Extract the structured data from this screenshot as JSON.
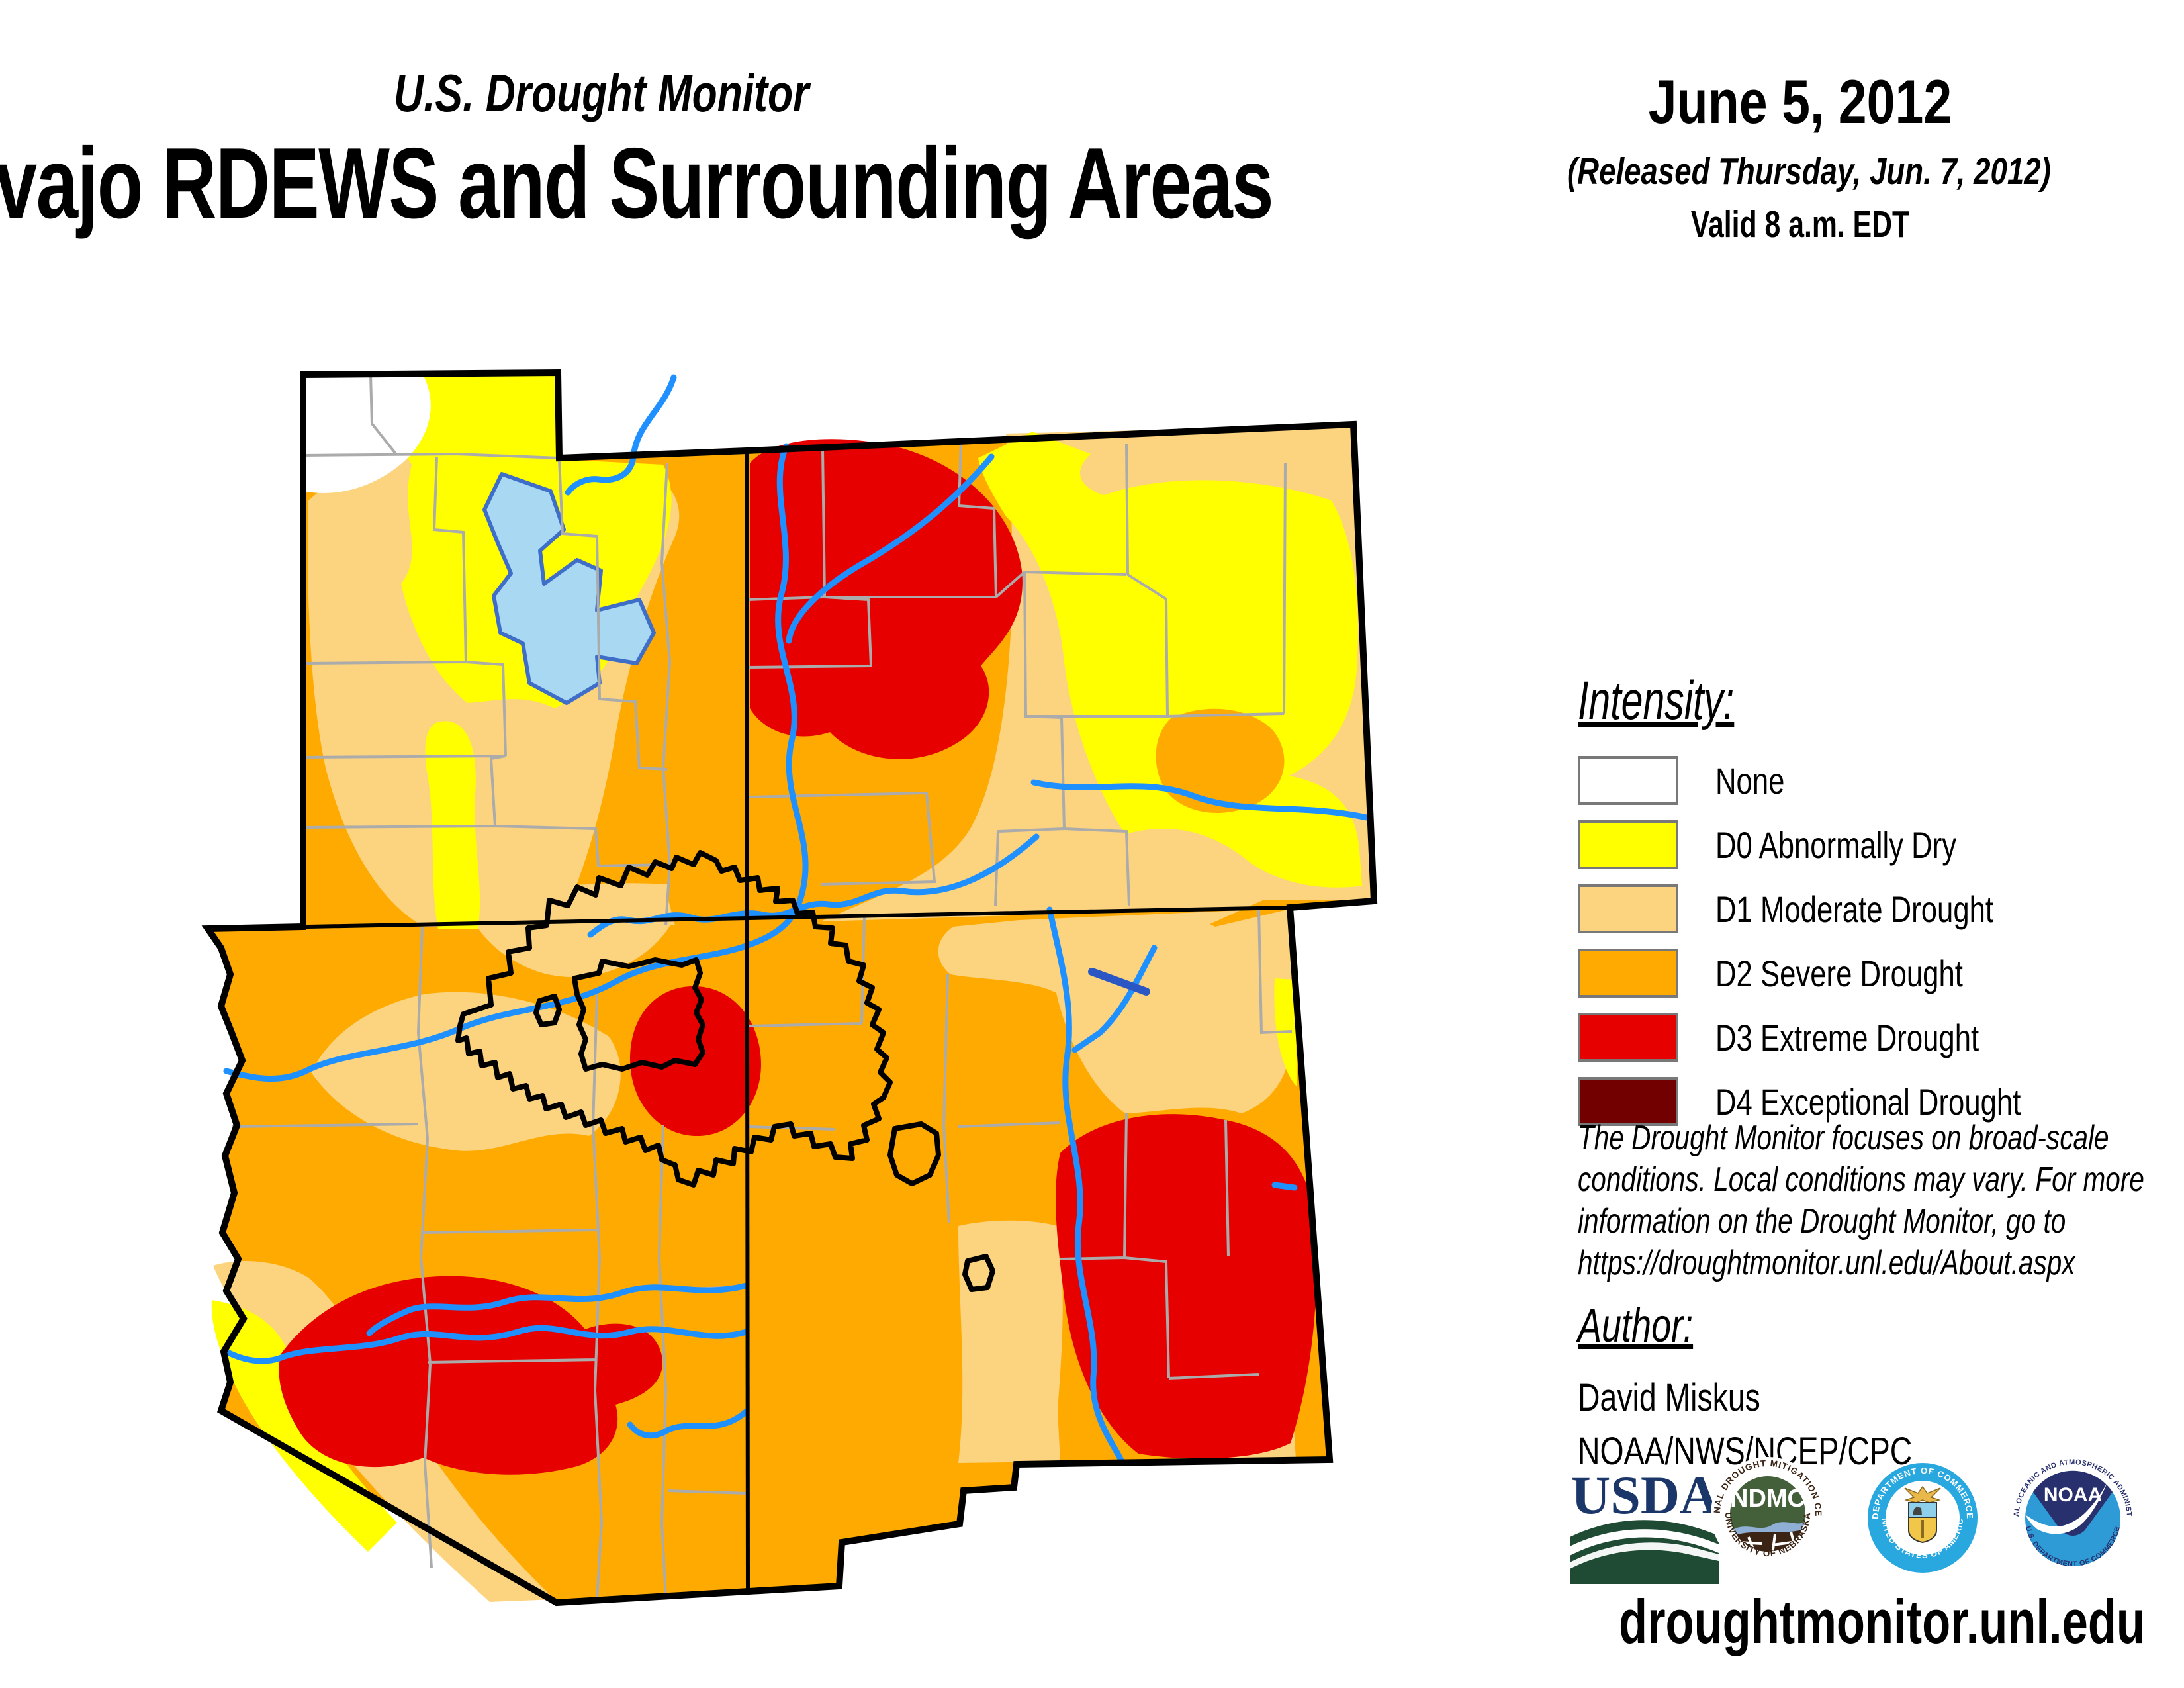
{
  "header": {
    "monitor_title": "U.S. Drought Monitor",
    "map_title": "Navajo RDEWS and Surrounding Areas",
    "date": "June 5, 2012",
    "released": "(Released Thursday, Jun. 7, 2012)",
    "valid": "Valid 8 a.m. EDT"
  },
  "legend": {
    "heading": "Intensity:",
    "items": [
      {
        "label": "None",
        "color": "#FFFFFF"
      },
      {
        "label": "D0 Abnormally Dry",
        "color": "#FFFF00"
      },
      {
        "label": "D1 Moderate Drought",
        "color": "#FCD37F"
      },
      {
        "label": "D2 Severe Drought",
        "color": "#FFAA00"
      },
      {
        "label": "D3 Extreme Drought",
        "color": "#E60000"
      },
      {
        "label": "D4 Exceptional Drought",
        "color": "#730000"
      }
    ]
  },
  "disclaimer": {
    "lines": [
      "The Drought Monitor focuses on broad-scale",
      "conditions. Local conditions may vary. For more",
      "information on the Drought Monitor, go to",
      "https://droughtmonitor.unl.edu/About.aspx"
    ]
  },
  "author": {
    "heading": "Author:",
    "name": "David Miskus",
    "org": "NOAA/NWS/NCEP/CPC"
  },
  "footer": {
    "url": "droughtmonitor.unl.edu"
  },
  "logos": {
    "usda": {
      "text": "USDA"
    },
    "ndmc": {
      "abbr": "NDMC",
      "ring_top": "NATIONAL DROUGHT MITIGATION CENTER",
      "ring_bottom": "UNIVERSITY OF NEBRASKA"
    },
    "commerce": {
      "ring_top": "DEPARTMENT OF COMMERCE",
      "ring_bottom": "UNITED STATES OF AMERICA"
    },
    "noaa": {
      "abbr": "NOAA",
      "ring_top": "NATIONAL OCEANIC AND ATMOSPHERIC ADMINISTRATION",
      "ring_bottom": "U.S. DEPARTMENT OF COMMERCE"
    }
  },
  "map": {
    "colors": {
      "none": "#FFFFFF",
      "d0_dry": "#FFFF00",
      "d1_moderate": "#FCD37F",
      "d2_severe": "#FFAA00",
      "d3_extreme": "#E60000",
      "d4_exceptional": "#730000",
      "river": "#1E90FF",
      "river_dark": "#2B57C4",
      "lake_fill": "#A9D9F2",
      "lake_stroke": "#3F6EC8",
      "county_line": "#ABABAB",
      "border": "#000000"
    }
  }
}
